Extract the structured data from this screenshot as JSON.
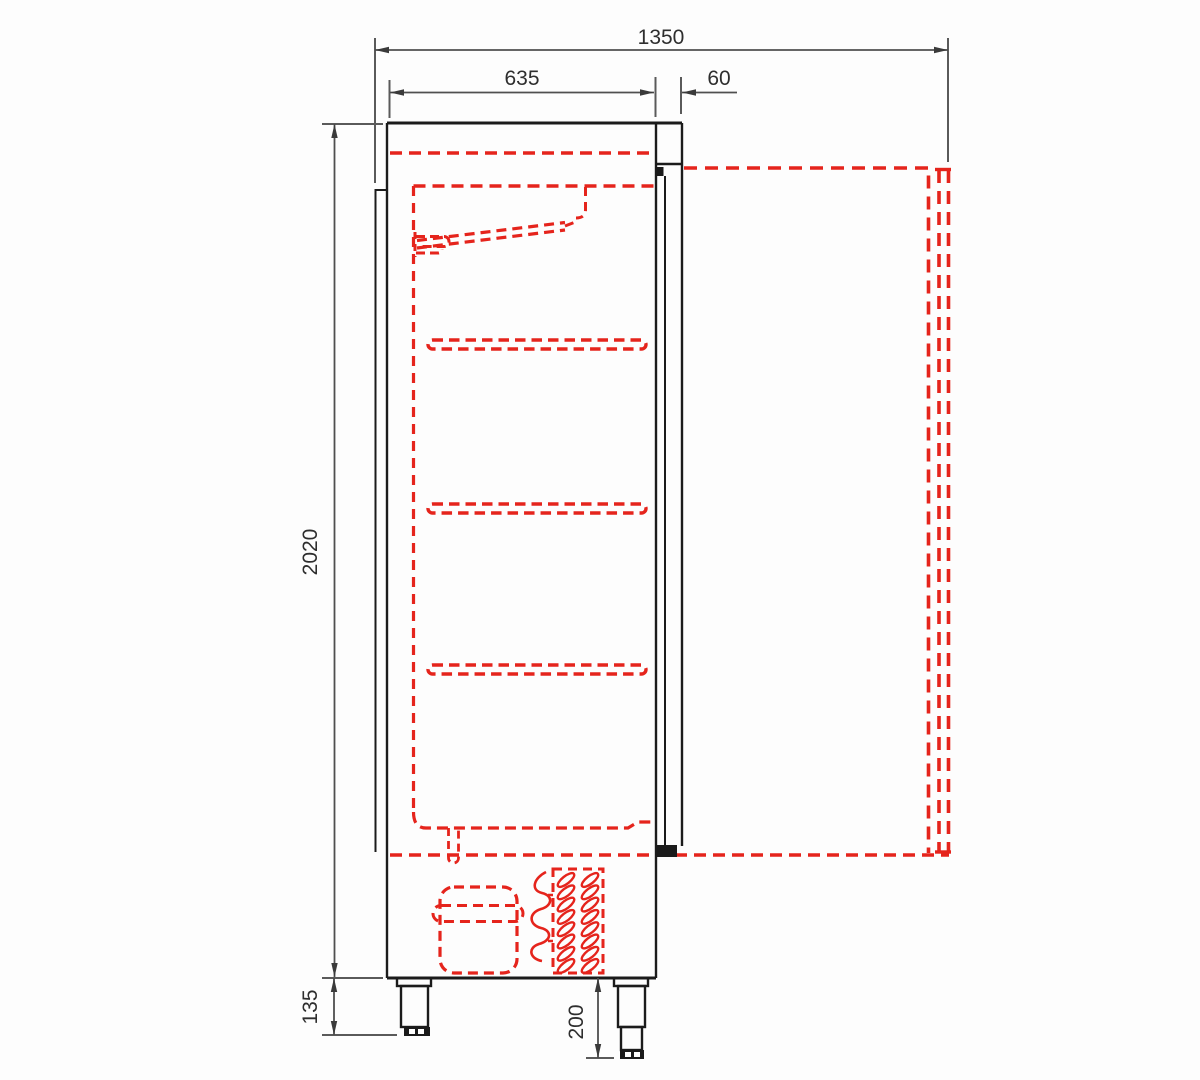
{
  "drawing": {
    "description": "Technical side-section drawing of an upright refrigerated cabinet with door shown open (red dashed projection), interior shelves, evaporator, compressor, condenser and adjustable feet",
    "colors": {
      "outline": "#1b1b1b",
      "dimension_lines": "#4f4f4f",
      "hidden_detail_red": "#e5241c",
      "text": "#2e2e2e",
      "background": "#fdfdfd"
    },
    "dimensions": {
      "total_depth_door_open": "1350",
      "body_depth": "635",
      "door_thickness": "60",
      "body_height": "2020",
      "foot_height_min": "135",
      "foot_height_max": "200"
    }
  }
}
